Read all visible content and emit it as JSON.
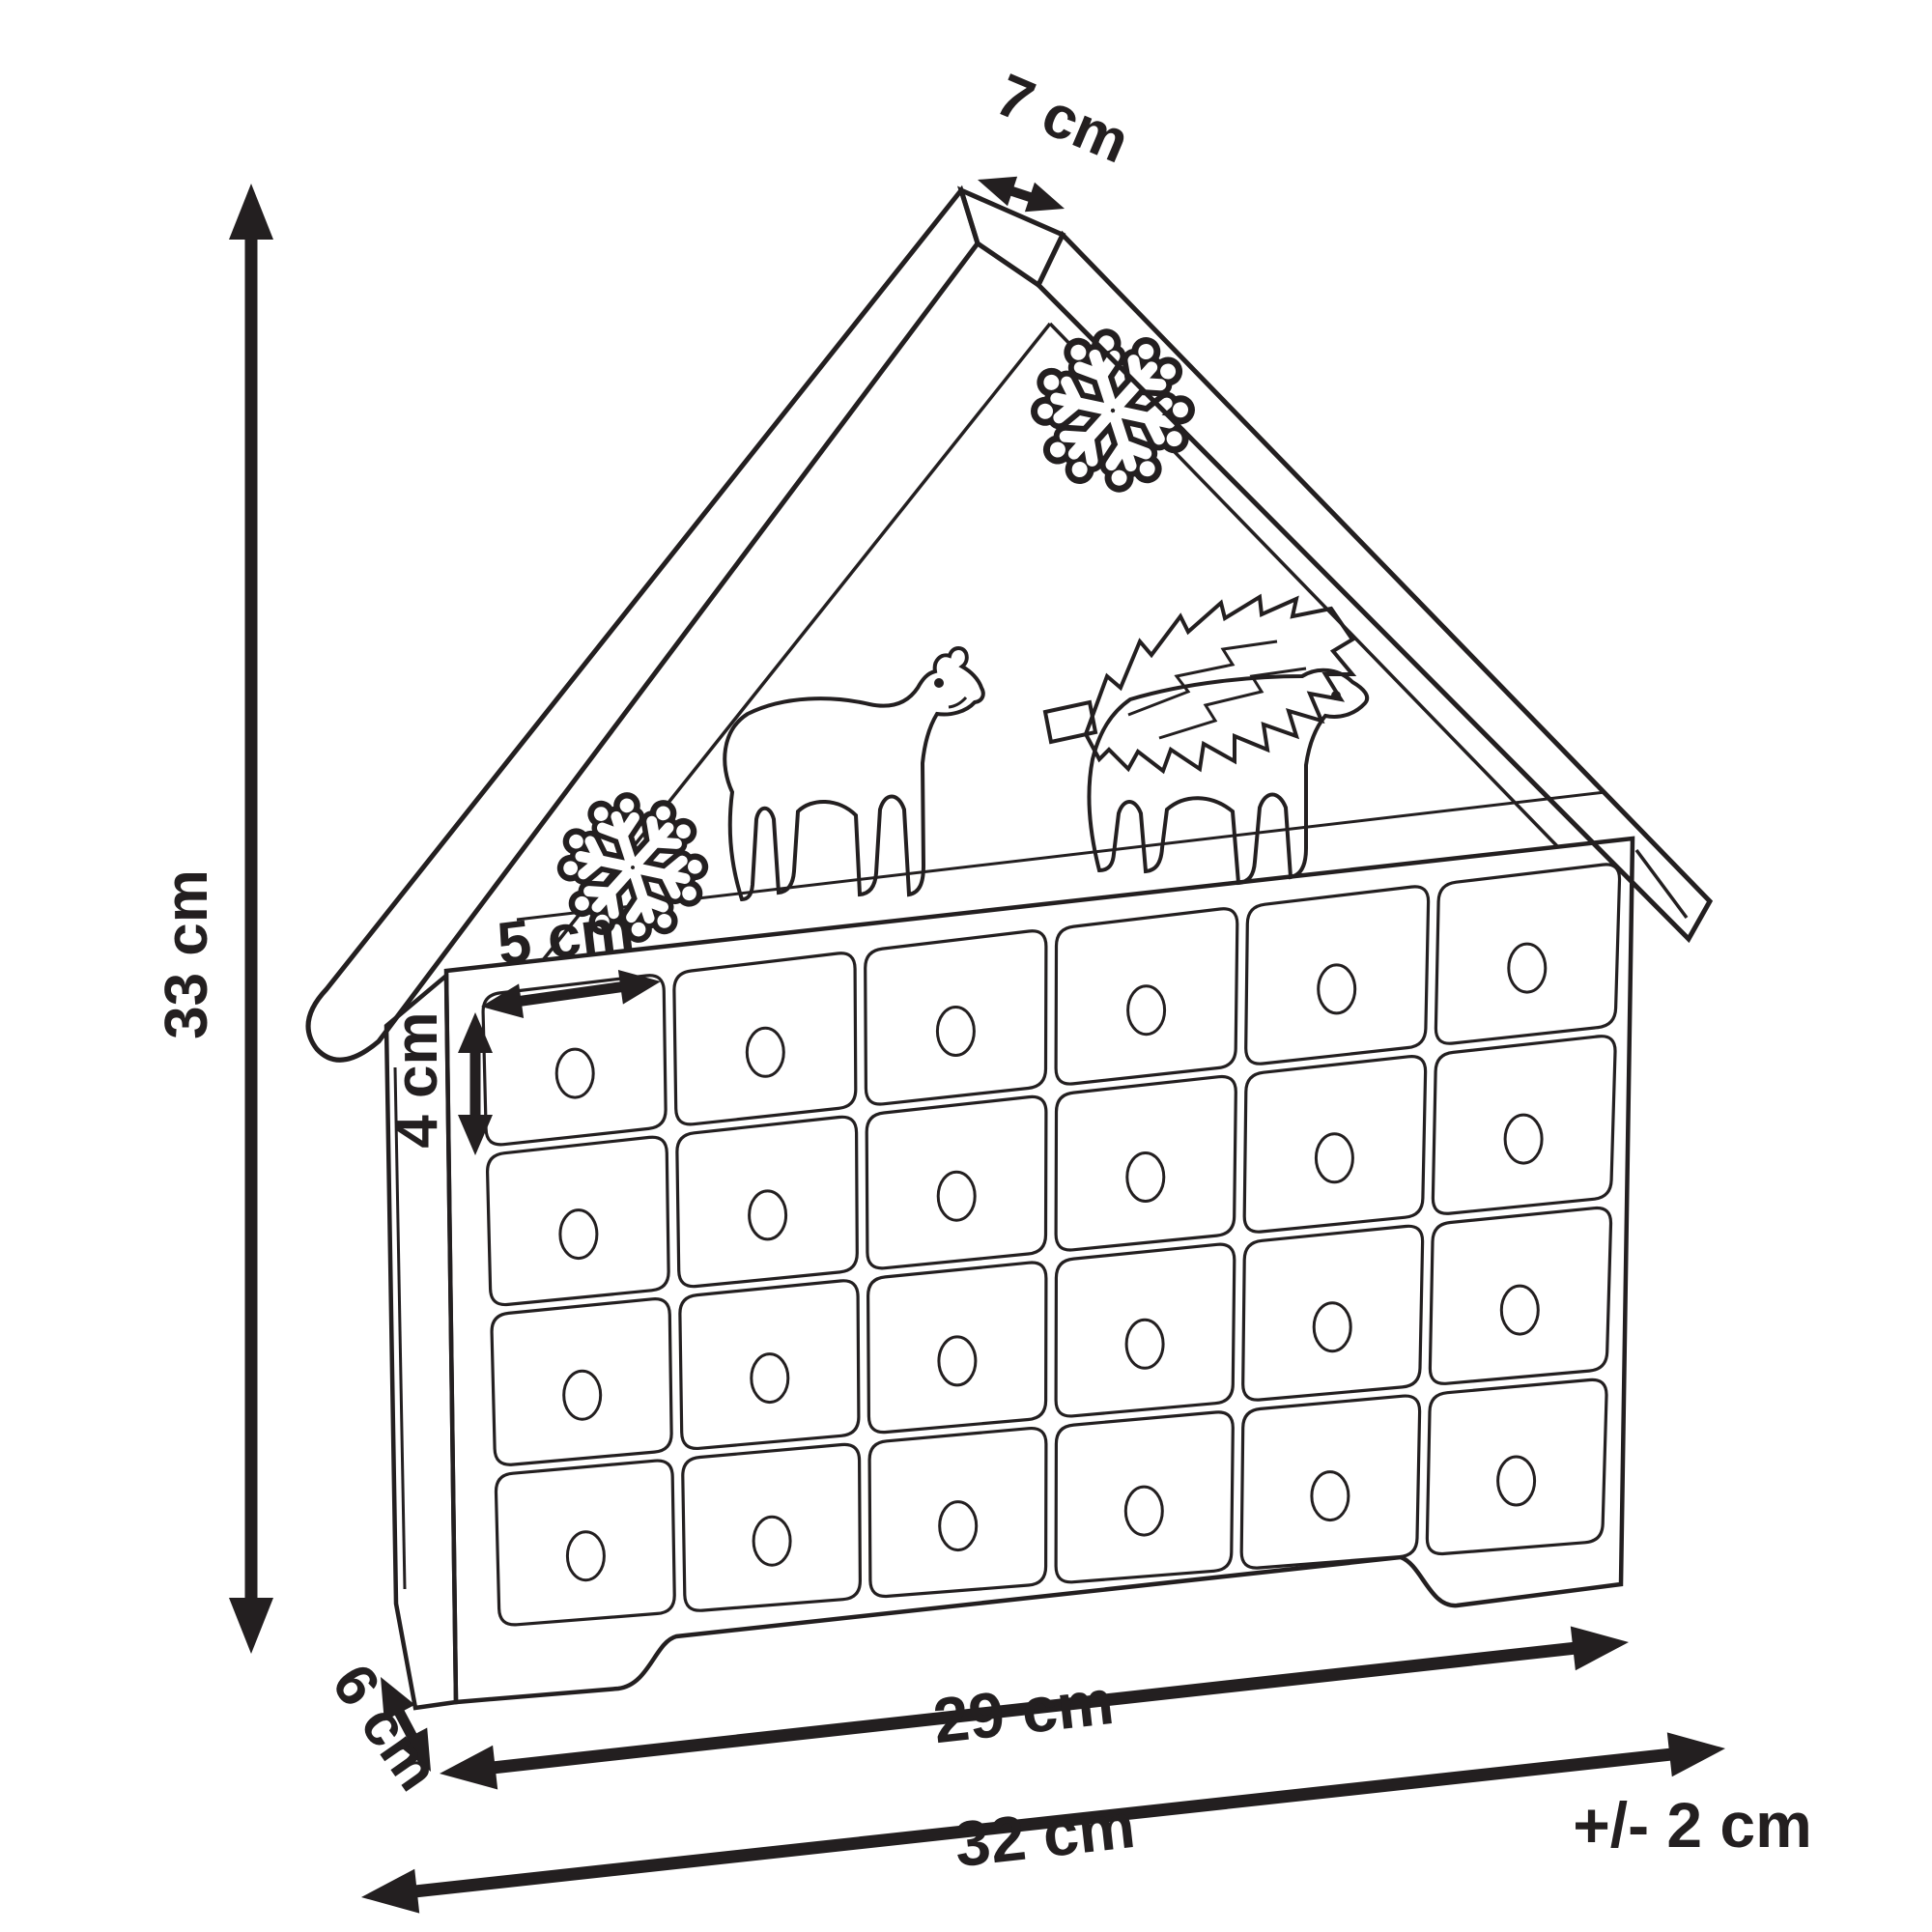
{
  "title": "House-shaped advent calendar dimension diagram",
  "dimensions": {
    "ridge_depth_label": "7 cm",
    "height_label": "33 cm",
    "drawer_width_label": "5 cm",
    "drawer_height_label": "4 cm",
    "depth_label": "6 cm",
    "inner_width_label": "29 cm",
    "total_width_label": "32 cm",
    "tolerance_label": "+/- 2 cm"
  },
  "structure": {
    "drawer_rows": 4,
    "drawer_cols": 6,
    "drawer_count": 24,
    "decorations": [
      "snowflake-top",
      "snowflake-left",
      "polar-bear",
      "polar-bear-carrying-fir-tree"
    ]
  },
  "colors": {
    "line": "#231f20",
    "background": "#ffffff"
  }
}
